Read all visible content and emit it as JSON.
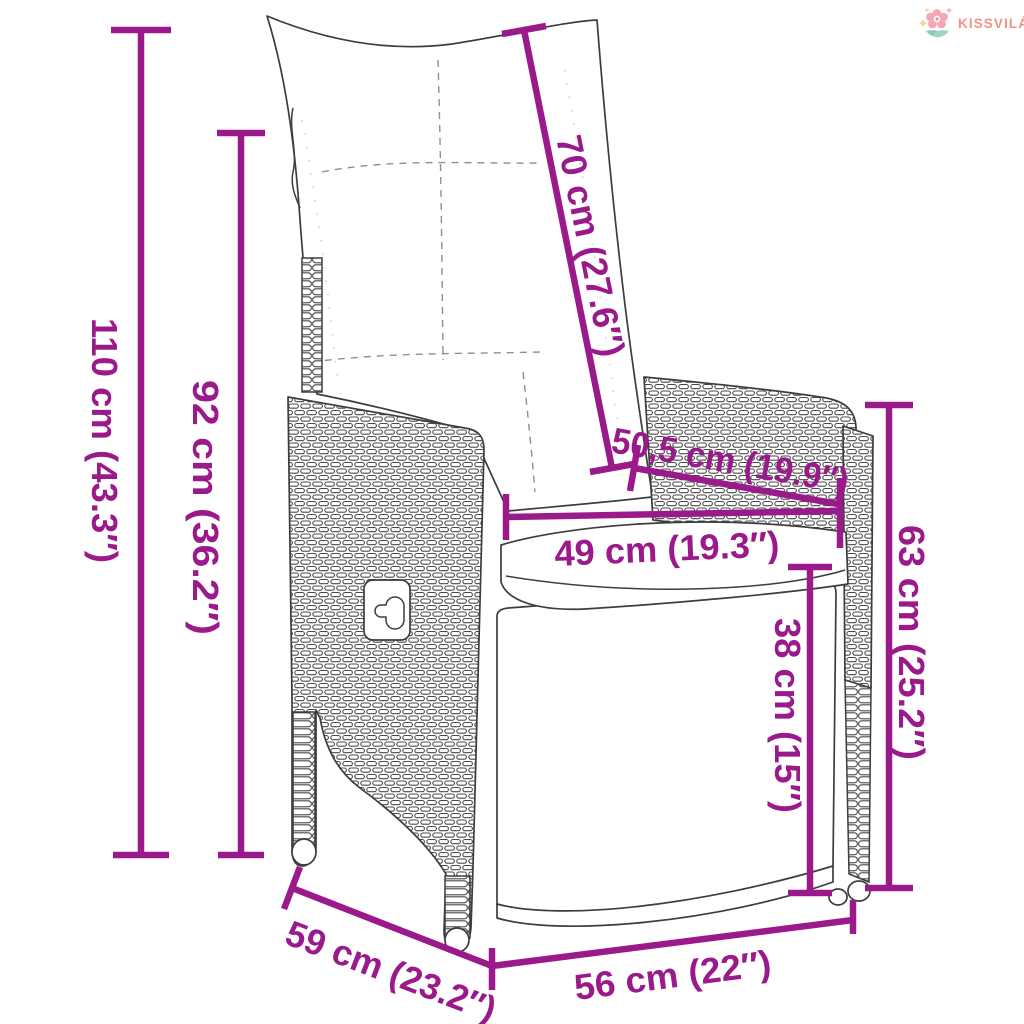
{
  "brand": {
    "name": "KISSVILÁG",
    "text_color": "#F09282",
    "flower_pink": "#F3A9B8",
    "leaf_teal": "#8BCBBE",
    "sparkle_yellow": "#F5D48D",
    "sparkle_pink": "#F2B3C2"
  },
  "diagram": {
    "type": "product-dimensions",
    "subject": "reclining-rattan-garden-chair-with-cushions",
    "accent_color": "#9B1A8B",
    "line_art_color": "#3d3d3d",
    "unit_primary": "cm",
    "unit_secondary": "in",
    "measurements": [
      {
        "id": "overall-height",
        "value_cm": 110,
        "value_in": 43.3,
        "label": "110 cm (43.3″)"
      },
      {
        "id": "back-height",
        "value_cm": 92,
        "value_in": 36.2,
        "label": "92 cm (36.2″)"
      },
      {
        "id": "backrest-length",
        "value_cm": 70,
        "value_in": 27.6,
        "label": "70 cm (27.6″)"
      },
      {
        "id": "back-width",
        "value_cm": 50.5,
        "value_in": 19.9,
        "label": "50,5 cm (19.9″)"
      },
      {
        "id": "seat-width",
        "value_cm": 49,
        "value_in": 19.3,
        "label": "49 cm (19.3″)"
      },
      {
        "id": "armrest-height",
        "value_cm": 63,
        "value_in": 25.2,
        "label": "63 cm (25.2″)"
      },
      {
        "id": "seat-height",
        "value_cm": 38,
        "value_in": 15,
        "label": "38 cm (15″)"
      },
      {
        "id": "seat-depth",
        "value_cm": 59,
        "value_in": 23.2,
        "label": "59 cm (23.2″)"
      },
      {
        "id": "front-width",
        "value_cm": 56,
        "value_in": 22,
        "label": "56 cm (22″)"
      }
    ]
  }
}
